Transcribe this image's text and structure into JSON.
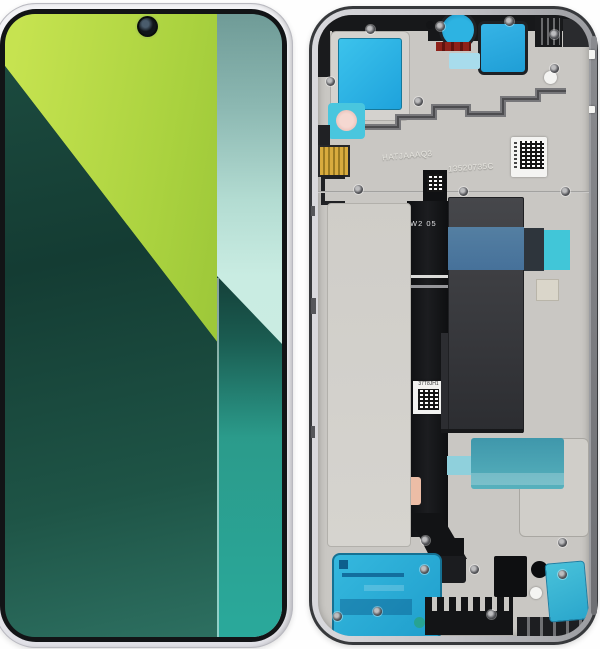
{
  "meta": {
    "description": "Product photo of a smartphone LCD display assembly: front view with diagonal green wallpaper (left) and rear mid-frame view with blue adhesive films, flex cable and QR stickers (right)"
  },
  "front_phone": {
    "camera": "punch-hole front camera",
    "frame_color": "#e9e9ee",
    "bezel_color": "#141619",
    "wallpaper": {
      "lime_green": "#a9d13e",
      "dark_green": "#17453a",
      "teal_gray_top": "#6f9b97",
      "mint": "#c9ece2",
      "dark_teal": "#143f38",
      "turquoise_bottom": "#2aa99b"
    }
  },
  "rear_assembly": {
    "frame_silver": "#c9c7c3",
    "rim_dark": "#37393c",
    "adhesive_cyan": "#2ab0dc",
    "steel_blue_band": "#4e7ba1",
    "flex_cable_black": "#121315",
    "labels": {
      "etched_code_left": "HATJAAAQ3",
      "etched_code_right": "13520735C",
      "flex_marking": "W2 05",
      "flex_sticker_code": "37T8JH1"
    },
    "stickers": {
      "qr_top_right": "QR code sticker",
      "qr_flex_bottom": "QR code sticker",
      "red_top": "red seal sticker"
    }
  }
}
